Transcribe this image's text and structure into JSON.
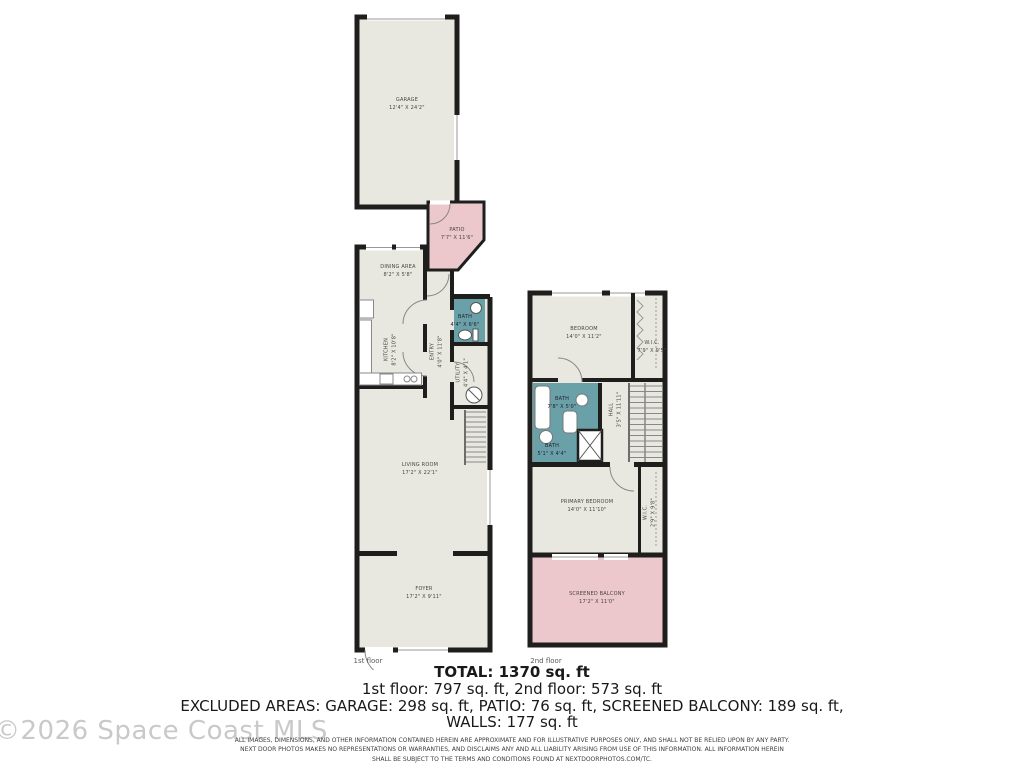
{
  "watermark": "©2026 Space Coast MLS",
  "colors": {
    "room_fill": "#e9e8e0",
    "excluded_fill": "#ecc7cc",
    "bath_fill": "#6aa0a7",
    "wall": "#1e1e1c"
  },
  "floor1": {
    "caption": "1st floor",
    "rooms": {
      "garage": {
        "name": "GARAGE",
        "dims": "12'4\" X 24'2\""
      },
      "patio": {
        "name": "PATIO",
        "dims": "7'7\" X 11'6\""
      },
      "dining": {
        "name": "DINING AREA",
        "dims": "8'2\" X 5'8\""
      },
      "kitchen": {
        "name": "KITCHEN",
        "dims": "8'2\" X 10'8\""
      },
      "entry": {
        "name": "ENTRY",
        "dims": "4'0\" X 11'8\""
      },
      "bath": {
        "name": "BATH",
        "dims": "4'4\" X 6'6\""
      },
      "utility": {
        "name": "UTILITY",
        "dims": "4'4\" X 4'1\""
      },
      "living": {
        "name": "LIVING ROOM",
        "dims": "17'2\" X 22'1\""
      },
      "foyer": {
        "name": "FOYER",
        "dims": "17'2\" X 9'11\""
      }
    }
  },
  "floor2": {
    "caption": "2nd floor",
    "rooms": {
      "bedroom": {
        "name": "BEDROOM",
        "dims": "14'0\" X 11'2\""
      },
      "wic1": {
        "name": "W.I.C.",
        "dims": "7'9\" X 9'5\""
      },
      "bath1": {
        "name": "BATH",
        "dims": "7'8\" X 5'0\""
      },
      "bath2": {
        "name": "BATH",
        "dims": "5'1\" X 4'4\""
      },
      "hall": {
        "name": "HALL",
        "dims": "3'5\" X 11'11\""
      },
      "primary": {
        "name": "PRIMARY BEDROOM",
        "dims": "14'0\" X 11'10\""
      },
      "wic2": {
        "name": "W.I.C.",
        "dims": "2'9\" X 9'8\""
      },
      "balcony": {
        "name": "SCREENED BALCONY",
        "dims": "17'2\" X 11'0\""
      }
    }
  },
  "summary": {
    "total": "TOTAL: 1370 sq. ft",
    "floors": "1st floor: 797 sq. ft, 2nd floor: 573 sq. ft",
    "excluded": "EXCLUDED AREAS: GARAGE: 298 sq. ft, PATIO: 76 sq. ft, SCREENED BALCONY: 189 sq. ft,",
    "walls": "WALLS: 177 sq. ft"
  },
  "disclaimer": {
    "line1": "ALL IMAGES, DIMENSIONS, AND OTHER INFORMATION CONTAINED HEREIN ARE APPROXIMATE AND FOR ILLUSTRATIVE PURPOSES ONLY, AND SHALL NOT BE RELIED UPON BY ANY PARTY.",
    "line2": "NEXT DOOR PHOTOS MAKES NO REPRESENTATIONS OR WARRANTIES, AND DISCLAIMS ANY AND ALL LIABILITY ARISING FROM USE OF THIS INFORMATION. ALL INFORMATION HEREIN",
    "line3": "SHALL BE SUBJECT TO THE TERMS AND CONDITIONS FOUND AT NEXTDOORPHOTOS.COM/TC."
  }
}
